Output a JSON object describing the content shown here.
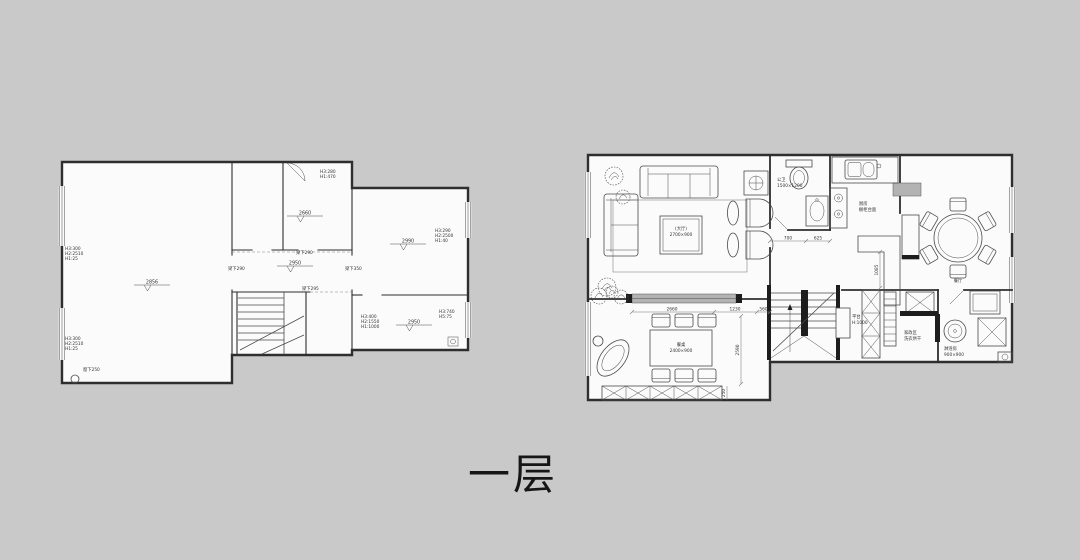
{
  "title": {
    "text": "一层"
  },
  "left_plan": {
    "levels": {
      "main": "2856",
      "ne_room": "2660",
      "corridor": "2950",
      "east_room": "2990",
      "se_room": "2950"
    },
    "wall_notes_top": [
      "H3:300",
      "H2:2510",
      "H1:25"
    ],
    "wall_notes_bottom": [
      "H3:300",
      "H2:2510",
      "H1:25"
    ],
    "sill_note": "窗下250",
    "ne_room_notes": [
      "H3:280",
      "H1:470"
    ],
    "east_room_notes": [
      "H3:290",
      "H2:2500",
      "H1:40"
    ],
    "se_room_notes_a": [
      "H3:400",
      "H2:1550",
      "H1:1000"
    ],
    "se_room_notes_b": [
      "H3:740",
      "H5:75"
    ],
    "beams": {
      "a": "梁下290",
      "b": "梁下290",
      "c": "梁下295",
      "d": "梁下350"
    }
  },
  "right_plan": {
    "living_table_label": [
      "(大厅)",
      "2700×900"
    ],
    "study_table_label": [
      "餐桌",
      "2400×900"
    ],
    "kitchen_label": [
      "厨房",
      "橱柜台面"
    ],
    "wc_label": [
      "公卫",
      "1500×1200"
    ],
    "dining_label": "餐厅",
    "stairs_label": [
      "平台",
      "H:1000"
    ],
    "utility_label": [
      "家政区",
      "洗衣烘干"
    ],
    "bath_label": [
      "淋浴房",
      "900×900"
    ],
    "dims": {
      "wc_a": "700",
      "wc_b": "625",
      "study_w": "2660",
      "study_w2": "1230",
      "study_w3": "560",
      "study_h": "2590",
      "study_b": "250",
      "kitchen_v": "1085"
    }
  }
}
